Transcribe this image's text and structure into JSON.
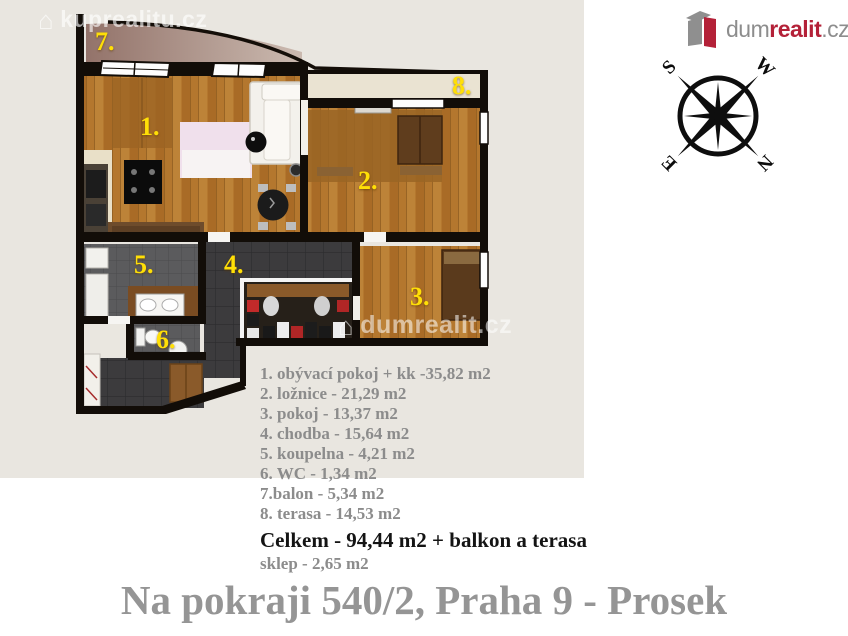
{
  "watermarks": {
    "top_left": "kuprealitu.cz",
    "plan": "dumrealit.cz"
  },
  "logo": {
    "part1": "dum",
    "part2": "realit",
    "part3": ".cz"
  },
  "compass": {
    "n": "N",
    "s": "S",
    "e": "E",
    "w": "W"
  },
  "plan": {
    "room_labels": [
      "1.",
      "2.",
      "3.",
      "4.",
      "5.",
      "6.",
      "7.",
      "8."
    ]
  },
  "legend": {
    "items": [
      "1. obývací pokoj + kk -35,82 m2",
      "2. ložnice - 21,29 m2",
      "3. pokoj - 13,37 m2",
      "4. chodba - 15,64 m2",
      "5. koupelna - 4,21 m2",
      "6. WC - 1,34 m2",
      "7.balon - 5,34 m2",
      "8. terasa - 14,53 m2"
    ],
    "total": "Celkem - 94,44 m2 + balkon a terasa",
    "cellar": "sklep - 2,65 m2"
  },
  "footer": {
    "title": "Na pokraji 540/2, Praha 9 - Prosek"
  },
  "colors": {
    "accent_red": "#b42138",
    "label_yellow": "#ffdf07",
    "panel_beige": "#e9e6e0",
    "wall_black": "#120d08"
  }
}
